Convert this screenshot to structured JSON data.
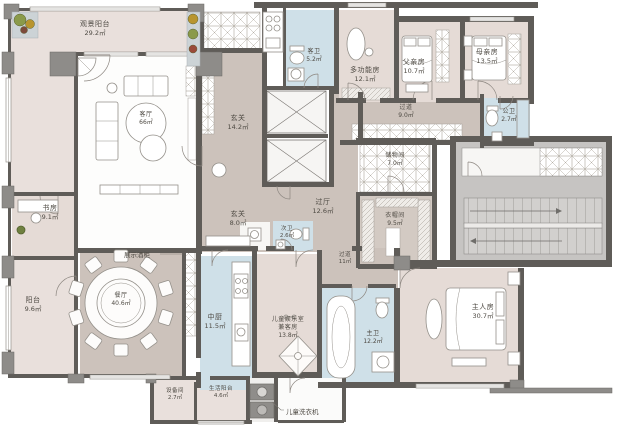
{
  "plan_title": "户型平面图",
  "rooms": {
    "view_balcony": {
      "label": "观景阳台",
      "area": "29.2㎡"
    },
    "living": {
      "label": "客厅",
      "area": "66㎡"
    },
    "foyer_upper": {
      "label": "玄关",
      "area": "14.2㎡"
    },
    "guest_bath": {
      "label": "客卫",
      "area": "5.2㎡"
    },
    "multi_room": {
      "label": "多功能房",
      "area": "12.1㎡"
    },
    "father_room": {
      "label": "父亲房",
      "area": "10.7㎡"
    },
    "mother_room": {
      "label": "母亲房",
      "area": "13.5㎡"
    },
    "corridor_north": {
      "label": "过道",
      "area": "9.0㎡"
    },
    "public_bath": {
      "label": "公卫",
      "area": "2.7㎡"
    },
    "hall": {
      "label": "过厅",
      "area": "12.6㎡"
    },
    "storage": {
      "label": "储物间",
      "area": "7.0㎡"
    },
    "cloakroom": {
      "label": "衣帽间",
      "area": "9.5㎡"
    },
    "study": {
      "label": "书房",
      "area": "9.1㎡"
    },
    "foyer_lower": {
      "label": "玄关",
      "area": "8.0㎡"
    },
    "second_bath": {
      "label": "次卫",
      "area": "2.6㎡"
    },
    "side_balcony": {
      "label": "阳台",
      "area": "9.6㎡"
    },
    "dining": {
      "label": "餐厅",
      "area": "40.6㎡"
    },
    "kitchen": {
      "label": "中厨",
      "area": "11.5㎡"
    },
    "kids_room": {
      "label": "儿童娱乐室",
      "label2": "兼客房",
      "area": "13.8㎡"
    },
    "corridor_south": {
      "label": "过道",
      "area": "11㎡"
    },
    "master_bath": {
      "label": "主卫",
      "area": "12.2㎡"
    },
    "master_room": {
      "label": "主人房",
      "area": "30.7㎡"
    },
    "equipment": {
      "label": "设备间",
      "area": "2.7㎡"
    },
    "service_balcony": {
      "label": "生活阳台",
      "area": "4.6㎡"
    }
  },
  "callouts": {
    "wine_cabinet": "展示酒柜",
    "kids_washer": "儿童洗衣机"
  },
  "colors": {
    "wall": "#5f5c58",
    "floor_tan": "#ccc2bb",
    "floor_pink": "#e5dbd6",
    "floor_blue": "#cfe0e8",
    "stair_gray": "#c6c4c2"
  }
}
